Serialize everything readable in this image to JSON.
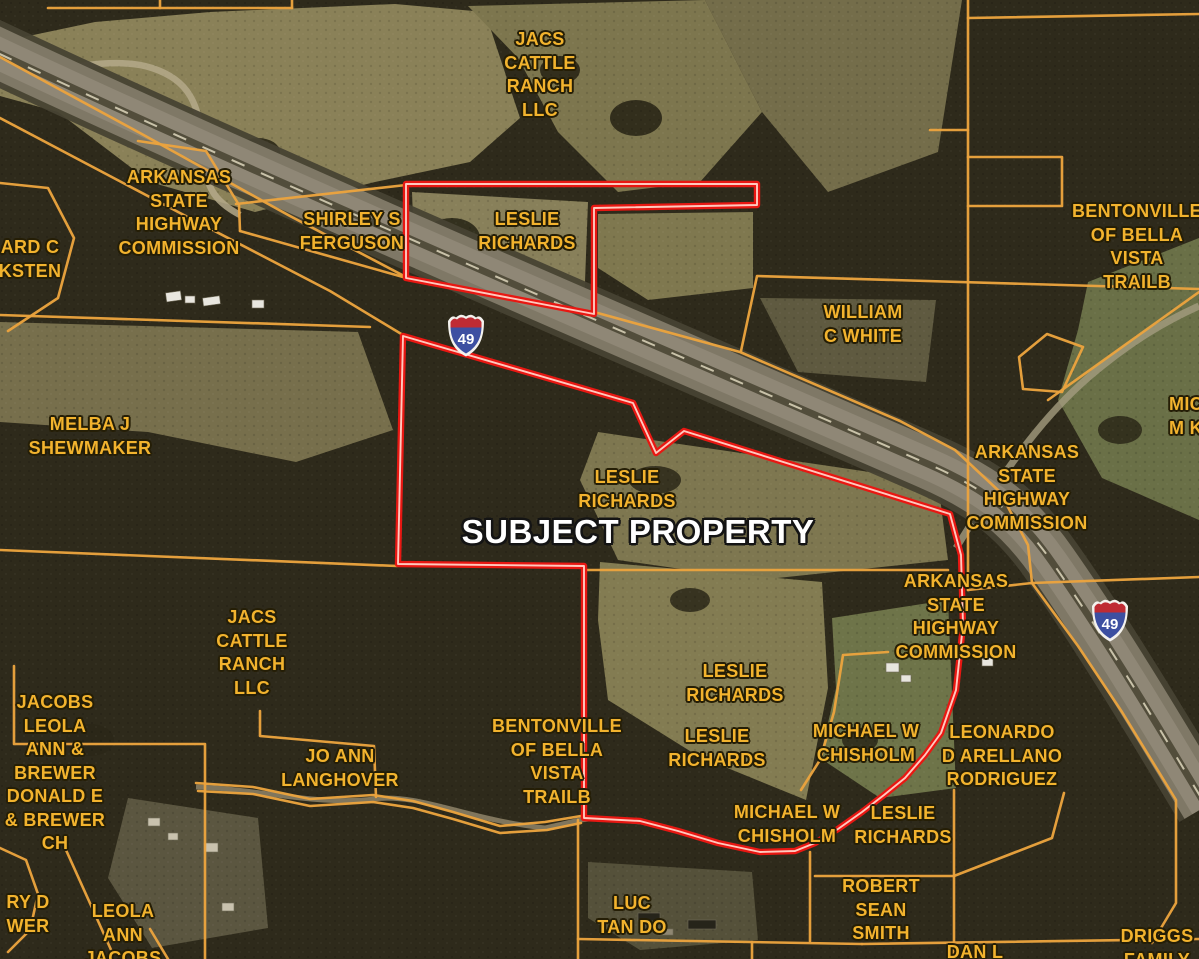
{
  "map": {
    "colors": {
      "label_yellow": "#f2b32e",
      "boundary_red": "#e81712",
      "parcel_orange": "#eaa33e",
      "subject_text": "#ffffff"
    },
    "highway_shields": [
      {
        "route": "49",
        "x": 466,
        "y": 334
      },
      {
        "route": "49",
        "x": 1110,
        "y": 619
      }
    ],
    "labels": [
      {
        "id": "label-jacs-cattle-ranch-top",
        "x": 540,
        "y": 40,
        "lines": [
          "JACS",
          "CATTLE",
          "RANCH",
          "LLC"
        ]
      },
      {
        "id": "label-arkansas-shc-topleft",
        "x": 179,
        "y": 178,
        "lines": [
          "ARKANSAS",
          "STATE",
          "HIGHWAY",
          "COMMISSION"
        ]
      },
      {
        "id": "label-ard-c-ksten-partial",
        "x": 30,
        "y": 248,
        "lines": [
          "ARD C",
          "KSTEN"
        ]
      },
      {
        "id": "label-shirley-s-ferguson",
        "x": 352,
        "y": 220,
        "lines": [
          "SHIRLEY S",
          "FERGUSON"
        ]
      },
      {
        "id": "label-leslie-richards-top",
        "x": 527,
        "y": 220,
        "lines": [
          "LESLIE",
          "RICHARDS"
        ]
      },
      {
        "id": "label-bentonville-bella-vista-topright",
        "x": 1137,
        "y": 212,
        "lines": [
          "BENTONVILLE",
          "OF BELLA",
          "VISTA",
          "TRAILB"
        ]
      },
      {
        "id": "label-william-c-white",
        "x": 863,
        "y": 313,
        "lines": [
          "WILLIAM",
          "C WHITE"
        ]
      },
      {
        "id": "label-melba-j-shewmaker",
        "x": 90,
        "y": 425,
        "lines": [
          "MELBA J",
          "SHEWMAKER"
        ]
      },
      {
        "id": "label-mic-mk-partial",
        "x": 1186,
        "y": 405,
        "lines": [
          "MIC",
          "M K"
        ]
      },
      {
        "id": "label-arkansas-shc-right-upper",
        "x": 1027,
        "y": 453,
        "lines": [
          "ARKANSAS",
          "STATE",
          "HIGHWAY",
          "COMMISSION"
        ]
      },
      {
        "id": "label-leslie-richards-center",
        "x": 627,
        "y": 478,
        "lines": [
          "LESLIE",
          "RICHARDS"
        ]
      },
      {
        "id": "label-subject-property",
        "x": 638,
        "y": 532,
        "style": "subject",
        "lines": [
          "SUBJECT PROPERTY"
        ]
      },
      {
        "id": "label-arkansas-shc-right-lower",
        "x": 956,
        "y": 582,
        "lines": [
          "ARKANSAS",
          "STATE",
          "HIGHWAY",
          "COMMISSION"
        ]
      },
      {
        "id": "label-jacs-cattle-ranch-left",
        "x": 252,
        "y": 618,
        "lines": [
          "JACS",
          "CATTLE",
          "RANCH",
          "LLC"
        ]
      },
      {
        "id": "label-jacobs-leola-brewer",
        "x": 55,
        "y": 703,
        "lines": [
          "JACOBS",
          "LEOLA",
          "ANN &",
          "BREWER",
          "DONALD E",
          "& BREWER",
          "CH"
        ]
      },
      {
        "id": "label-leslie-richards-mid1",
        "x": 735,
        "y": 672,
        "lines": [
          "LESLIE",
          "RICHARDS"
        ]
      },
      {
        "id": "label-bentonville-bella-vista-bottom",
        "x": 557,
        "y": 727,
        "lines": [
          "BENTONVILLE",
          "OF BELLA",
          "VISTA",
          "TRAILB"
        ]
      },
      {
        "id": "label-jo-ann-langhover",
        "x": 340,
        "y": 757,
        "lines": [
          "JO ANN",
          "LANGHOVER"
        ]
      },
      {
        "id": "label-leslie-richards-mid2",
        "x": 717,
        "y": 737,
        "lines": [
          "LESLIE",
          "RICHARDS"
        ]
      },
      {
        "id": "label-michael-w-chisholm-upper",
        "x": 866,
        "y": 732,
        "lines": [
          "MICHAEL W",
          "CHISHOLM"
        ]
      },
      {
        "id": "label-leonardo-d-arellano-rodriguez",
        "x": 1002,
        "y": 733,
        "lines": [
          "LEONARDO",
          "D ARELLANO",
          "RODRIGUEZ"
        ]
      },
      {
        "id": "label-michael-w-chisholm-lower",
        "x": 787,
        "y": 813,
        "lines": [
          "MICHAEL W",
          "CHISHOLM"
        ]
      },
      {
        "id": "label-leslie-richards-bottomright",
        "x": 903,
        "y": 814,
        "lines": [
          "LESLIE",
          "RICHARDS"
        ]
      },
      {
        "id": "label-ry-d-wer-partial",
        "x": 28,
        "y": 903,
        "lines": [
          "RY D",
          "WER"
        ]
      },
      {
        "id": "label-leola-ann-jacobs",
        "x": 123,
        "y": 912,
        "lines": [
          "LEOLA",
          "ANN",
          "JACOBS"
        ]
      },
      {
        "id": "label-luc-tan-do",
        "x": 632,
        "y": 904,
        "lines": [
          "LUC",
          "TAN DO"
        ]
      },
      {
        "id": "label-robert-sean-smith",
        "x": 881,
        "y": 887,
        "lines": [
          "ROBERT",
          "SEAN",
          "SMITH"
        ]
      },
      {
        "id": "label-dan-l-partial",
        "x": 975,
        "y": 953,
        "lines": [
          "DAN L"
        ]
      },
      {
        "id": "label-driggs-family-partial",
        "x": 1157,
        "y": 937,
        "lines": [
          "DRIGGS",
          "FAMILY"
        ]
      }
    ],
    "subject_boundary": [
      [
        [
          406,
          184
        ],
        [
          757,
          184
        ],
        [
          757,
          205
        ],
        [
          594,
          208
        ],
        [
          594,
          314
        ],
        [
          406,
          278
        ]
      ],
      [
        [
          403,
          336
        ],
        [
          633,
          403
        ],
        [
          656,
          453
        ],
        [
          684,
          431
        ],
        [
          950,
          514
        ],
        [
          961,
          555
        ],
        [
          963,
          625
        ],
        [
          956,
          690
        ],
        [
          941,
          733
        ],
        [
          925,
          755
        ],
        [
          905,
          778
        ],
        [
          884,
          795
        ],
        [
          862,
          812
        ],
        [
          838,
          829
        ],
        [
          815,
          843
        ],
        [
          795,
          851
        ],
        [
          760,
          852
        ],
        [
          718,
          843
        ],
        [
          678,
          831
        ],
        [
          640,
          821
        ],
        [
          584,
          818
        ],
        [
          584,
          566
        ],
        [
          398,
          564
        ]
      ]
    ],
    "parcel_lines": [
      [
        [
          48,
          8
        ],
        [
          292,
          8
        ]
      ],
      [
        [
          160,
          0
        ],
        [
          160,
          8
        ]
      ],
      [
        [
          292,
          0
        ],
        [
          292,
          8
        ]
      ],
      [
        [
          0,
          57
        ],
        [
          140,
          133
        ],
        [
          290,
          216
        ],
        [
          406,
          277
        ]
      ],
      [
        [
          236,
          204
        ],
        [
          406,
          185
        ]
      ],
      [
        [
          240,
          231
        ],
        [
          403,
          277
        ]
      ],
      [
        [
          138,
          141
        ],
        [
          206,
          151
        ],
        [
          239,
          205
        ],
        [
          240,
          231
        ]
      ],
      [
        [
          0,
          183
        ],
        [
          48,
          188
        ],
        [
          74,
          238
        ],
        [
          58,
          298
        ],
        [
          8,
          331
        ]
      ],
      [
        [
          0,
          315
        ],
        [
          370,
          327
        ]
      ],
      [
        [
          0,
          550
        ],
        [
          397,
          566
        ]
      ],
      [
        [
          0,
          118
        ],
        [
          180,
          213
        ],
        [
          330,
          291
        ],
        [
          403,
          335
        ]
      ],
      [
        [
          594,
          312
        ],
        [
          740,
          352
        ],
        [
          900,
          421
        ],
        [
          955,
          450
        ],
        [
          1000,
          492
        ],
        [
          1028,
          545
        ],
        [
          1032,
          583
        ]
      ],
      [
        [
          1199,
          289
        ],
        [
          757,
          276
        ],
        [
          741,
          351
        ]
      ],
      [
        [
          968,
          0
        ],
        [
          968,
          590
        ]
      ],
      [
        [
          968,
          18
        ],
        [
          1199,
          14
        ]
      ],
      [
        [
          930,
          130
        ],
        [
          968,
          130
        ]
      ],
      [
        [
          968,
          157
        ],
        [
          1062,
          157
        ],
        [
          1062,
          206
        ],
        [
          968,
          206
        ]
      ],
      [
        [
          968,
          590
        ],
        [
          1032,
          583
        ],
        [
          1199,
          577
        ]
      ],
      [
        [
          1032,
          583
        ],
        [
          1078,
          646
        ],
        [
          1122,
          712
        ],
        [
          1176,
          800
        ],
        [
          1176,
          903
        ],
        [
          1152,
          943
        ]
      ],
      [
        [
          1048,
          400
        ],
        [
          1199,
          292
        ]
      ],
      [
        [
          1023,
          389
        ],
        [
          1019,
          357
        ],
        [
          1047,
          334
        ],
        [
          1083,
          347
        ],
        [
          1062,
          392
        ],
        [
          1023,
          389
        ]
      ],
      [
        [
          584,
          570
        ],
        [
          948,
          570
        ]
      ],
      [
        [
          14,
          666
        ],
        [
          14,
          744
        ],
        [
          205,
          744
        ],
        [
          205,
          959
        ]
      ],
      [
        [
          260,
          711
        ],
        [
          260,
          736
        ],
        [
          374,
          746
        ],
        [
          376,
          797
        ]
      ],
      [
        [
          196,
          783
        ],
        [
          253,
          787
        ],
        [
          310,
          799
        ],
        [
          373,
          795
        ],
        [
          413,
          801
        ],
        [
          453,
          812
        ],
        [
          500,
          826
        ],
        [
          545,
          822
        ],
        [
          581,
          816
        ]
      ],
      [
        [
          198,
          791
        ],
        [
          253,
          794
        ],
        [
          310,
          806
        ],
        [
          373,
          802
        ],
        [
          413,
          808
        ],
        [
          453,
          819
        ],
        [
          500,
          833
        ],
        [
          547,
          830
        ],
        [
          581,
          823
        ]
      ],
      [
        [
          0,
          848
        ],
        [
          26,
          860
        ],
        [
          38,
          894
        ],
        [
          30,
          930
        ],
        [
          8,
          952
        ]
      ],
      [
        [
          66,
          850
        ],
        [
          112,
          952
        ]
      ],
      [
        [
          150,
          929
        ],
        [
          168,
          959
        ]
      ],
      [
        [
          578,
          820
        ],
        [
          578,
          959
        ]
      ],
      [
        [
          578,
          939
        ],
        [
          862,
          944
        ]
      ],
      [
        [
          810,
          852
        ],
        [
          810,
          941
        ]
      ],
      [
        [
          752,
          942
        ],
        [
          752,
          959
        ]
      ],
      [
        [
          888,
          652
        ],
        [
          843,
          655
        ],
        [
          834,
          712
        ],
        [
          820,
          760
        ],
        [
          801,
          790
        ]
      ],
      [
        [
          815,
          876
        ],
        [
          954,
          876
        ],
        [
          1052,
          838
        ],
        [
          1064,
          793
        ]
      ],
      [
        [
          954,
          790
        ],
        [
          954,
          959
        ]
      ],
      [
        [
          862,
          944
        ],
        [
          1199,
          939
        ]
      ],
      [
        [
          975,
          944
        ],
        [
          975,
          959
        ]
      ]
    ]
  }
}
